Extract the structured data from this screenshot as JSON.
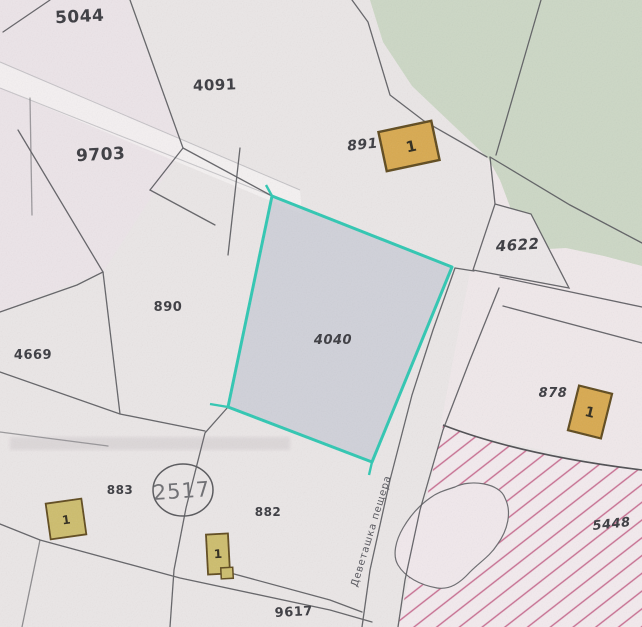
{
  "map": {
    "type": "cadastral-parcel-map",
    "parcel_labels": [
      {
        "id": "5044",
        "text": "5044"
      },
      {
        "id": "4091",
        "text": "4091"
      },
      {
        "id": "9703",
        "text": "9703"
      },
      {
        "id": "891",
        "text": "891"
      },
      {
        "id": "4622",
        "text": "4622"
      },
      {
        "id": "890",
        "text": "890"
      },
      {
        "id": "4040",
        "text": "4040"
      },
      {
        "id": "4669",
        "text": "4669"
      },
      {
        "id": "878",
        "text": "878"
      },
      {
        "id": "883",
        "text": "883"
      },
      {
        "id": "882",
        "text": "882"
      },
      {
        "id": "5448",
        "text": "5448"
      },
      {
        "id": "9617",
        "text": "9617"
      }
    ],
    "circled_label": "2517",
    "street_name": "Деветашка пещера",
    "building_marks": [
      "1",
      "1",
      "1",
      "1"
    ],
    "highlighted_parcel": "4040",
    "colors": {
      "paper": "#eae6e6",
      "paper_pink": "#f1e7ea",
      "green_area": "#ccd7c5",
      "highlight_border": "#2fc7b2",
      "highlight_fill": "#c9ccd6",
      "hatch_line": "#c76a8e",
      "hatch_bg": "#f3eaee",
      "building_fill": "#d8a94f",
      "building_small_fill": "#cdbd6d",
      "building_border": "#5f4a1e",
      "boundary_line": "#55555a",
      "label_ink": "#3b3b40",
      "highlight_label_ink": "#3f4468"
    }
  }
}
